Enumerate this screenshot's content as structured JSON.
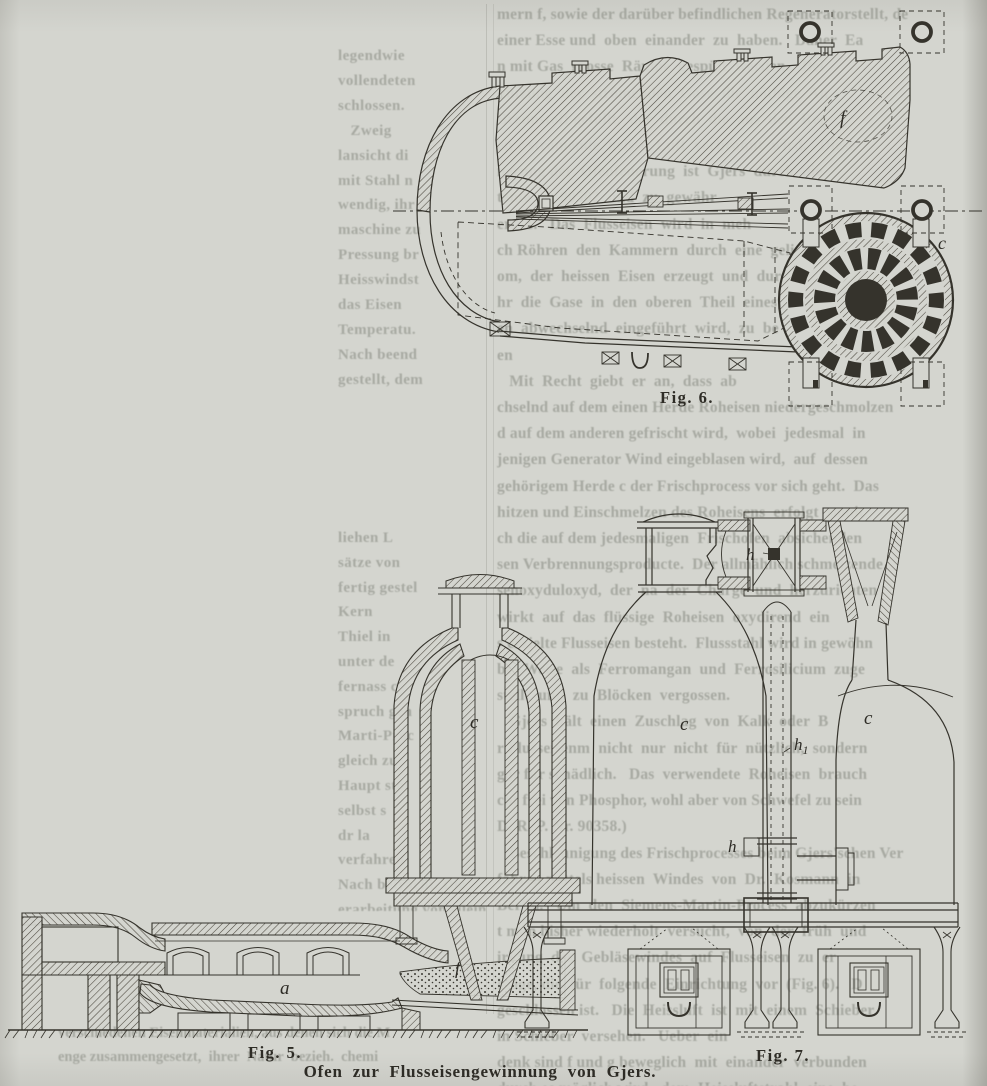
{
  "page": {
    "bg": "#d4d5cf",
    "ink": "#35332c",
    "ghost_color": "#83867d",
    "paper_fill": "#d4d5cf"
  },
  "captions": {
    "fig5": "Fig. 5.",
    "fig6": "Fig. 6.",
    "fig7": "Fig. 7.",
    "main": "Ofen zur Flusseisengewinnung von Gjers."
  },
  "labels": {
    "fig6_f": "f",
    "fig6_c": "c",
    "fig5_c": "c",
    "fig5_a": "a",
    "fig5_f": "f",
    "fig7_c_left": "c",
    "fig7_c_right": "c",
    "fig7_h_junction": "h",
    "fig7_h_valve": "h",
    "fig7_h1_base": "h",
    "fig7_h1_sub": "1"
  },
  "ghost_text": {
    "left_top": [
      "legendwie",
      "vollendeten",
      "schlossen.",
      "   Zweig",
      "lansicht di",
      "mit Stahl n",
      "wendig, ihr",
      "maschine zu",
      "Pressung br",
      "Heisswindst",
      "das Eisen",
      "Temperatu.",
      "Nach beend",
      "gestellt, dem"
    ],
    "left_mid": [
      "liehen L",
      "sätze von",
      "fertig gestel",
      "Kern",
      "Thiel in",
      "unter de",
      "fernass c",
      "spruch gen",
      "Marti-Proc",
      "gleich zu",
      "Haupt stol",
      "selbst s",
      "dr la",
      "verfahren",
      "Nach betracht. Die",
      "erarbeitung von silein."
    ],
    "right": [
      "mern f, sowie der darüber befindlichen Regeneratorstellt, de",
      "einer Esse und  oben  einander  zu  haben.   Daher  Ea",
      "n mit Gas  grosse  Räume  gespült  werden.   Bei",
      "nutzung  der  strömenden  Gase  die  nöthige  An",
      "Brennstoff gefüllt,  der  durch  die  aus  den  Reg",
      "en c strömende  heisse  Luft  verbrannt  wird.   Diese",
      "nerung der  Ofenfeuerung  ist  Gjers  durch  die",
      "tente Nr. 80502  und  zu  gewähr",
      "ers  1.   Das  Flusseisen  wird  in  meh",
      "ch Röhren  den  Kammern  durch  eine  gelindes  Wind",
      "om,  der  heissen  Eisen  erzeugt  und  durch  ein",
      "hr  die  Gase  in  den  oberen  Theil  eines",
      "en  abwechselnd  eingeführt  wird,  zu  be",
      "en",
      "   Mit  Recht  giebt  er  an,  dass  ab",
      "chselnd auf dem einen Herde Roheisen niedergeschmolzen",
      "d auf dem anderen gefrischt wird,  wobei  jedesmal  in",
      "jenigen Generator Wind eingeblasen wird,  auf  dessen",
      "gehörigem Herde c der Frischprocess vor sich geht.  Das",
      "hitzen und Einschmelzen des Roheisens  erfolgt  somit",
      "ch die auf dem jedesmaligen  Frischofen  absichenden",
      "sen Verbrennungsproducte.  Der allmählich schmelzende",
      "senoxyduloxyd,  der  na  der  Charge  und  herzurichten",
      "wirkt  auf  das  flüssige  Roheisen  oxydirend  ein",
      "s erzielte Flusseisen besteht.  Flussstahl wird in gewöhn",
      "ber Weise  als  Ferromangan  und  Ferrosilicium  zuge",
      "stellt  und  zu  Blöcken  vergossen.",
      "   Gjers  hält  einen  Zuschlag  von  Kalk  oder  B",
      "r Flusseisenm  nicht  nur  nicht  für  nützlich,  sondern",
      "gar für schädlich.   Das  verwendete  Roheisen  brauch",
      "cht frei von Phosphor, wohl aber von Schwefel zu sein",
      "D. R. P. Nr. 90358.)",
      "   Beschleunigung des Frischprocesses beim Gjers'schen Ver",
      "fahren mittels heissen  Windes  von  Dr.  Kosmann  in",
      "Berlin.   Um  den  Siemens-Martin-Process  abzukürzen",
      "t man bisher wiederholt  versucht,  von  der  früh  und",
      "irkung  des  Gebläsewindes  auf  Flusseisen  zu  er",
      "hläge, die  für  folgende  Einrichtung  vor  (Fig. 6).   D",
      "geschlossen ist.   Die  Heissluft  ist  mit  einem  Schieber",
      "in Schieber  versehen.   Ueber  ein",
      "denk sind f und g beweglich  mit  einander  verbunden",
      "durch es möglich wird,  dem  Heissluftstrahl  eine  be"
    ],
    "bottom_left": [
      "verschiedenen Eisenmaterialien, aus denen sich die M",
      "enge zusammengesetzt,  ihrer  Natur  bezieh.  chemi"
    ]
  }
}
